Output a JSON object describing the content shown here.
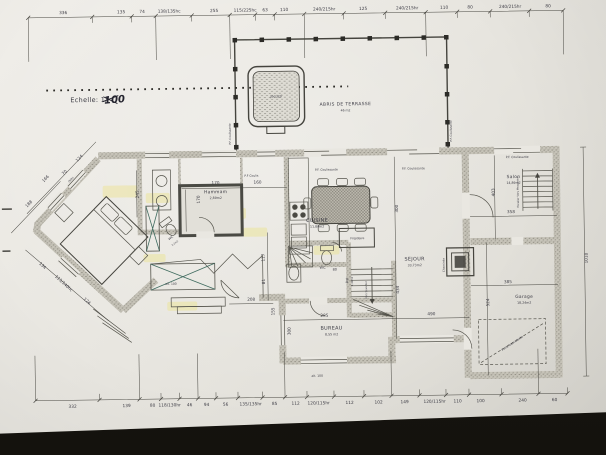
{
  "scale": {
    "printed": "Echelle: 1/",
    "hand": "100"
  },
  "dims_top": {
    "labels": [
      {
        "t": "336",
        "x": 66
      },
      {
        "t": "135",
        "x": 124
      },
      {
        "t": "74",
        "x": 145
      },
      {
        "t": "138/135hc",
        "x": 172
      },
      {
        "t": "255",
        "x": 217
      },
      {
        "t": "115/225hc",
        "x": 248
      },
      {
        "t": "63",
        "x": 268
      },
      {
        "t": "110",
        "x": 287
      },
      {
        "t": "240/215hr",
        "x": 327
      },
      {
        "t": "125",
        "x": 366
      },
      {
        "t": "240/215hr",
        "x": 410
      },
      {
        "t": "110",
        "x": 447
      },
      {
        "t": "80",
        "x": 473
      },
      {
        "t": "240/215hr",
        "x": 513
      },
      {
        "t": "80",
        "x": 551
      }
    ]
  },
  "dims_bottom": {
    "labels": [
      {
        "t": "332",
        "x": 70
      },
      {
        "t": "139",
        "x": 124
      },
      {
        "t": "80",
        "x": 150
      },
      {
        "t": "118/130hr",
        "x": 167
      },
      {
        "t": "46",
        "x": 187
      },
      {
        "t": "94",
        "x": 204
      },
      {
        "t": "56",
        "x": 223
      },
      {
        "t": "135/135hr",
        "x": 248
      },
      {
        "t": "85",
        "x": 272
      },
      {
        "t": "112",
        "x": 293
      },
      {
        "t": "120/115hr",
        "x": 316
      },
      {
        "t": "112",
        "x": 347
      },
      {
        "t": "102",
        "x": 376
      },
      {
        "t": "149",
        "x": 402
      },
      {
        "t": "120/115hr",
        "x": 432
      },
      {
        "t": "110",
        "x": 455
      },
      {
        "t": "100",
        "x": 478
      },
      {
        "t": "240",
        "x": 520
      },
      {
        "t": "60",
        "x": 552
      }
    ]
  },
  "dims_misc": [
    {
      "t": "188",
      "x": 30,
      "y": 201,
      "rot": -45
    },
    {
      "t": "166",
      "x": 47,
      "y": 176,
      "rot": -45
    },
    {
      "t": "70",
      "x": 66,
      "y": 170,
      "rot": -45
    },
    {
      "t": "(90h)",
      "x": 72,
      "y": 177,
      "rot": -45,
      "s": 2.6
    },
    {
      "t": "124",
      "x": 81,
      "y": 156,
      "rot": -45
    },
    {
      "t": "134",
      "x": 41,
      "y": 263,
      "rot": 43
    },
    {
      "t": "113/140hc",
      "x": 62,
      "y": 281,
      "rot": 43
    },
    {
      "t": "124",
      "x": 85,
      "y": 299,
      "rot": 43
    },
    {
      "t": "170",
      "x": 216,
      "y": 183
    },
    {
      "t": "170",
      "x": 200,
      "y": 198,
      "rot": -90
    },
    {
      "t": "160",
      "x": 258,
      "y": 183
    },
    {
      "t": "245",
      "x": 139,
      "y": 192,
      "rot": -90
    },
    {
      "t": "300",
      "x": 398,
      "y": 210,
      "rot": -90
    },
    {
      "t": "434",
      "x": 398,
      "y": 291,
      "rot": -90
    },
    {
      "t": "490",
      "x": 430,
      "y": 317
    },
    {
      "t": "285",
      "x": 323,
      "y": 317
    },
    {
      "t": "300",
      "x": 289,
      "y": 331,
      "rot": -90
    },
    {
      "t": "358",
      "x": 511,
      "y": 216
    },
    {
      "t": "403",
      "x": 495,
      "y": 195,
      "rot": -90
    },
    {
      "t": "385",
      "x": 507,
      "y": 286
    },
    {
      "t": "524",
      "x": 488,
      "y": 305,
      "rot": -90
    },
    {
      "t": "1010",
      "x": 587,
      "y": 262,
      "rot": -90
    },
    {
      "t": "117",
      "x": 264,
      "y": 257,
      "rot": -90
    },
    {
      "t": "81",
      "x": 264,
      "y": 281,
      "rot": -90
    },
    {
      "t": "208",
      "x": 250,
      "y": 300
    },
    {
      "t": "155",
      "x": 273,
      "y": 311,
      "rot": -90
    },
    {
      "t": "80",
      "x": 334,
      "y": 271,
      "s": 3.4
    }
  ],
  "rooms": [
    {
      "name": "Hammam",
      "area": "2,89m2",
      "x": 216,
      "y": 192,
      "s": 4.4
    },
    {
      "name": "CUISINE",
      "area": "11,89m2",
      "x": 317,
      "y": 222
    },
    {
      "name": "SEJOUR",
      "area": "33,73m2",
      "x": 414,
      "y": 262
    },
    {
      "name": "Salon",
      "area": "14,89m2",
      "x": 514,
      "y": 181,
      "s": 4.4
    },
    {
      "name": "Garage",
      "area": "18,24m2",
      "x": 523,
      "y": 301,
      "s": 4.4
    },
    {
      "name": "BUREAU",
      "area": "8,55 m2",
      "x": 330,
      "y": 330
    },
    {
      "name": "WC",
      "area": "",
      "x": 322,
      "y": 269,
      "s": 3.4
    }
  ],
  "annotations": [
    {
      "t": "ABRIS DE TERRASSE",
      "x": 347,
      "y": 106,
      "s": 4.4,
      "ls": 0.4,
      "n": "terrace-label"
    },
    {
      "t": "46 m2",
      "x": 347,
      "y": 112,
      "s": 3.1,
      "n": "terrace-area-label"
    },
    {
      "t": "Jacuzzi",
      "x": 278,
      "y": 97,
      "s": 3.4,
      "n": "jacuzzi-label"
    },
    {
      "t": "P.F. Coulissante",
      "x": 327,
      "y": 171,
      "s": 3,
      "n": "door-label"
    },
    {
      "t": "P.F. Coulissante",
      "x": 414,
      "y": 171,
      "s": 3,
      "n": "door-label"
    },
    {
      "t": "P.F. Coulissante",
      "x": 518,
      "y": 161,
      "s": 3,
      "n": "door-label"
    },
    {
      "t": "P.F Coulis",
      "x": 252,
      "y": 176,
      "s": 3,
      "n": "door-label"
    },
    {
      "t": "P.F. Coulissante",
      "x": 232,
      "y": 133,
      "s": 2.8,
      "rot": -90,
      "n": "door-label"
    },
    {
      "t": "P.F. Coulissante",
      "x": 453,
      "y": 133,
      "s": 2.8,
      "rot": -90,
      "n": "door-label"
    },
    {
      "t": "Cheminée",
      "x": 444,
      "y": 267,
      "s": 2.8,
      "rot": -90,
      "n": "fireplace-label"
    },
    {
      "t": "Escalier Vers Mezzanine",
      "x": 519,
      "y": 195,
      "s": 2.6,
      "rot": -90,
      "n": "stairs-label"
    },
    {
      "t": "Vers Sous Sol",
      "x": 366,
      "y": 291,
      "s": 2.6,
      "rot": -90,
      "n": "stairs-label"
    },
    {
      "t": "Porte basculante",
      "x": 511,
      "y": 347,
      "s": 3,
      "rot": -33,
      "n": "garage-door-label"
    },
    {
      "t": "Dgt",
      "x": 347,
      "y": 281,
      "s": 3,
      "rot": -90,
      "n": "room-label"
    },
    {
      "t": "1,40m2",
      "x": 352,
      "y": 282,
      "s": 2.4,
      "rot": -90,
      "n": "room-area-label"
    },
    {
      "t": "WC",
      "x": 171,
      "y": 237,
      "s": 3.2,
      "rot": -35,
      "n": "room-label"
    },
    {
      "t": "1,2m2",
      "x": 175,
      "y": 242,
      "s": 2.4,
      "rot": -35,
      "n": "room-area-label"
    },
    {
      "t": "Frigidaire",
      "x": 357,
      "y": 240,
      "s": 3,
      "n": "fridge-label"
    },
    {
      "t": "alt. 100",
      "x": 315,
      "y": 377,
      "s": 3,
      "n": "altitude-note"
    },
    {
      "t": "alt. 100",
      "x": 170,
      "y": 283,
      "s": 3,
      "n": "altitude-note"
    }
  ]
}
